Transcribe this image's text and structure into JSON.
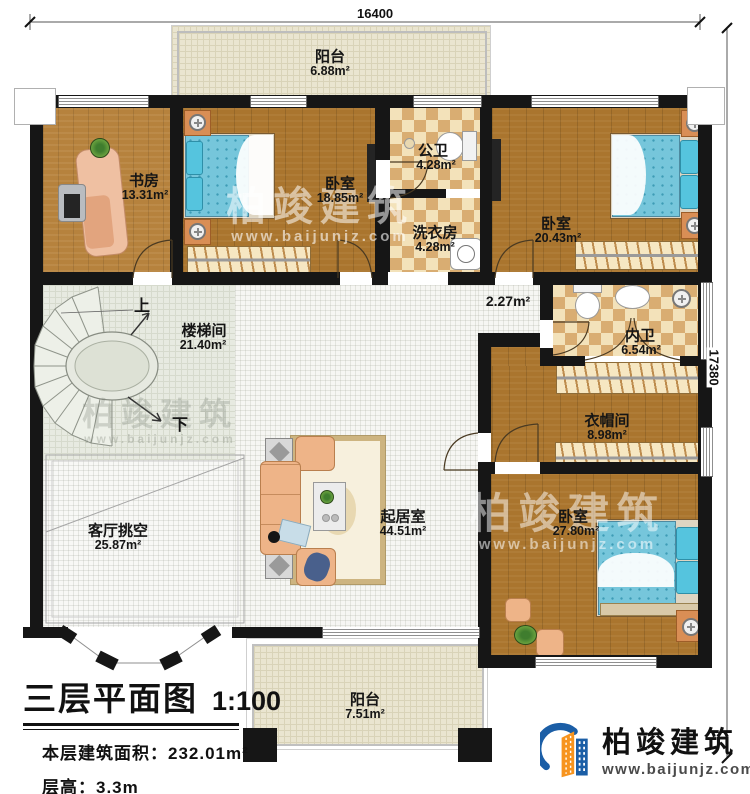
{
  "meta": {
    "title": "三层平面图",
    "scale": "1:100",
    "floor_area_label": "本层建筑面积：",
    "floor_area_value": "232.01m²",
    "floor_height_label": "层高：",
    "floor_height_value": "3.3m"
  },
  "dimensions": {
    "top": "16400",
    "right": "17380"
  },
  "stair": {
    "up": "上",
    "down": "下"
  },
  "corridor_area": "2.27m²",
  "rooms": [
    {
      "name": "阳台",
      "area": "6.88m²"
    },
    {
      "name": "书房",
      "area": "13.31m²"
    },
    {
      "name": "卧室",
      "area": "18.85m²"
    },
    {
      "name": "公卫",
      "area": "4.28m²"
    },
    {
      "name": "洗衣房",
      "area": "4.28m²"
    },
    {
      "name": "卧室",
      "area": "20.43m²"
    },
    {
      "name": "楼梯间",
      "area": "21.40m²"
    },
    {
      "name": "内卫",
      "area": "6.54m²"
    },
    {
      "name": "衣帽间",
      "area": "8.98m²"
    },
    {
      "name": "起居室",
      "area": "44.51m²"
    },
    {
      "name": "卧室",
      "area": "27.80m²"
    },
    {
      "name": "客厅挑空",
      "area": "25.87m²"
    },
    {
      "name": "阳台",
      "area": "7.51m²"
    }
  ],
  "brand": {
    "company": "柏竣建筑",
    "website": "www.baijunjz.com"
  },
  "colors": {
    "wall": "#161616",
    "wood": "#aa752e",
    "tile_dark": "#d9ad72",
    "tile_light": "#f3e2ba",
    "balcony": "#eae5d0",
    "bed_blue": "#76c6db",
    "sofa_peach": "#eeb488",
    "logo_blue": "#1b5ea6",
    "logo_orange": "#f7941e"
  }
}
